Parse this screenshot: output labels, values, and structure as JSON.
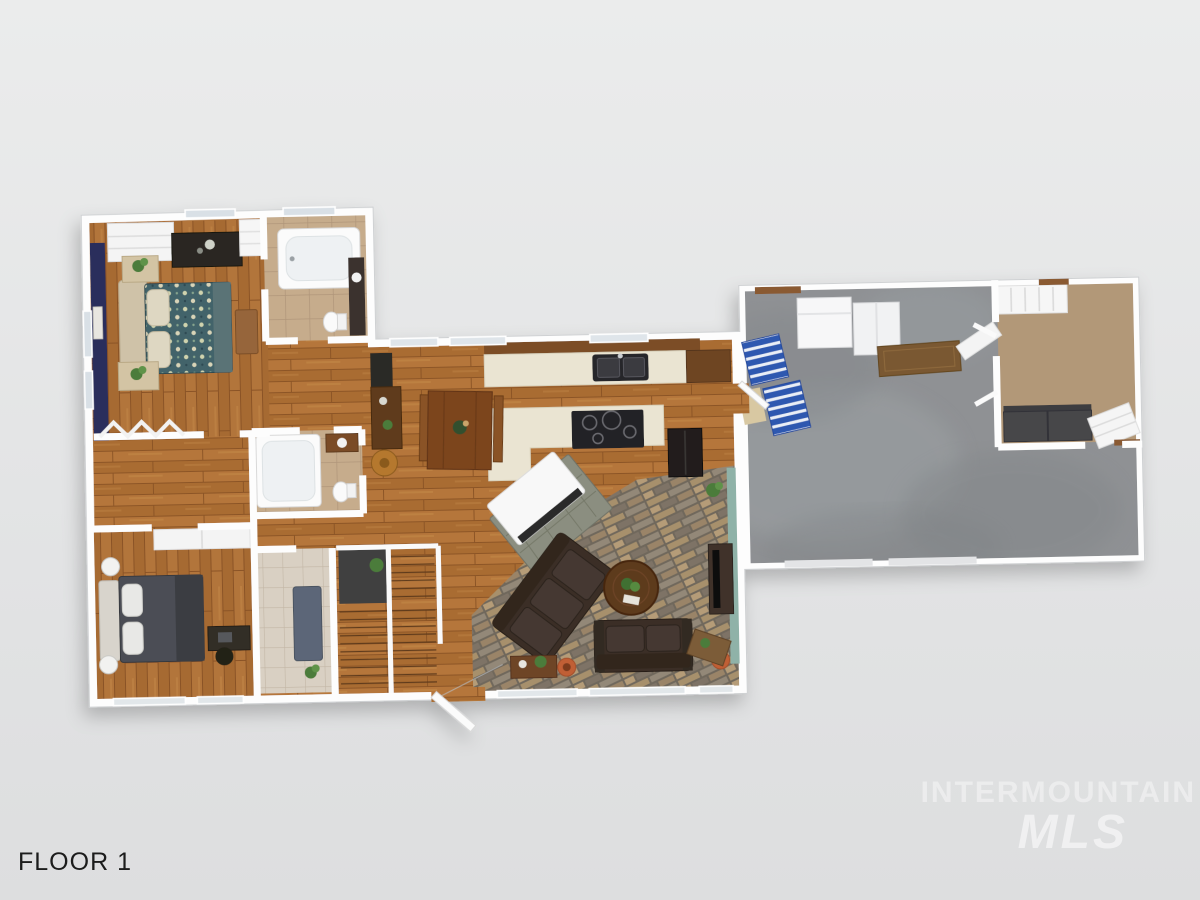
{
  "labels": {
    "floor": "FLOOR 1"
  },
  "watermark": {
    "brand": "INTERMOUNTAIN",
    "brand_sub": "MLS"
  },
  "palette": {
    "background": "#e4e5e6",
    "walls_white": "#ffffff",
    "wood_floor": "#b0722f",
    "accent_wall_navy": "#2a2f5c",
    "tile_tan": "#c6ac8c",
    "tile_light": "#d9d0c3",
    "brick_mortar": "#6f675c",
    "concrete_gray": "#8f9194",
    "carpet_tan": "#b29878",
    "counter_cream": "#eae4d2",
    "quilt_teal": "#43646a",
    "bed2_quilt_gray": "#4b4e54",
    "sofa_brown": "#3b2f26",
    "bonus_couch_gray": "#46464a",
    "teal_accent": "#8fb2a8",
    "runner_blue": "#5c6678",
    "rug_sage": "#b5bda4",
    "stair_mat_blue": "#2e58b0",
    "pot_terracotta": "#c05f35",
    "door_mat_brown": "#7a5832"
  }
}
